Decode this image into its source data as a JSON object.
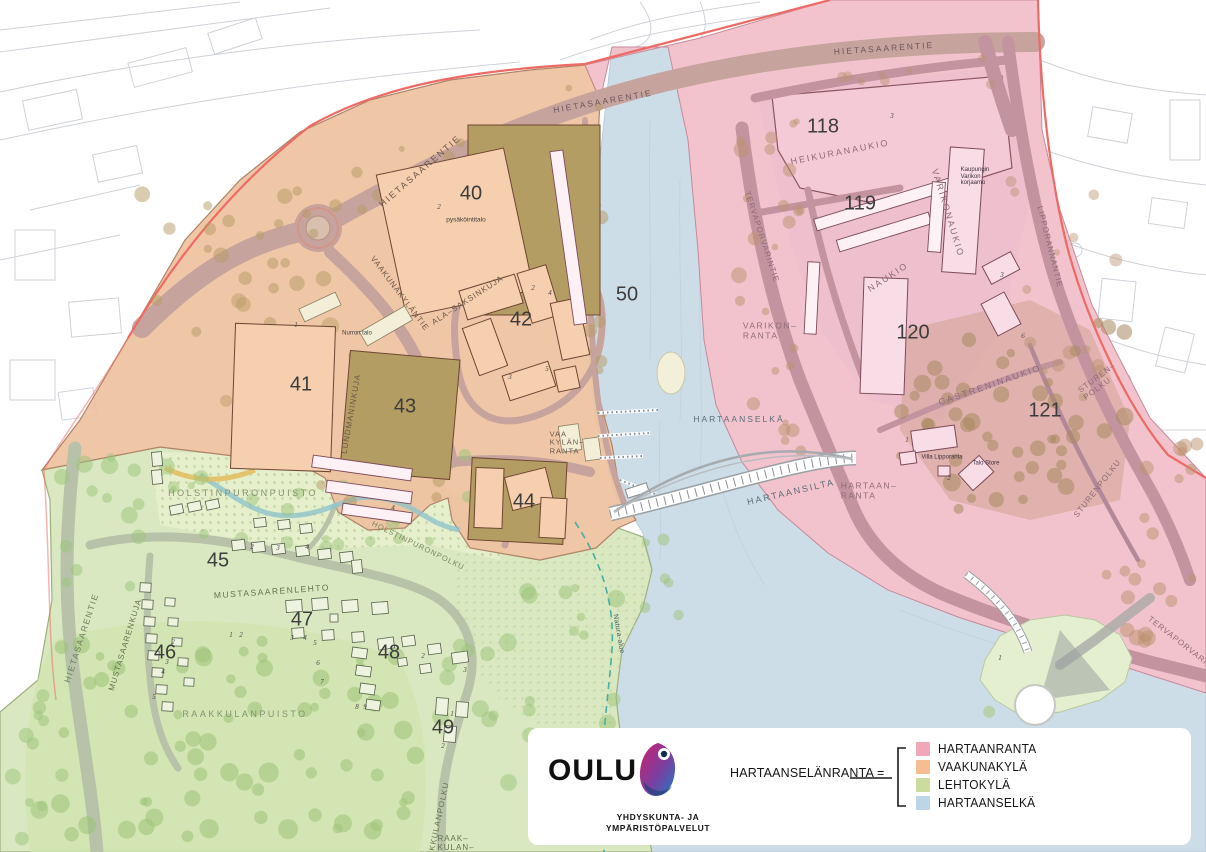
{
  "legend": {
    "logo_text": "OULU",
    "org_line1": "YHDYSKUNTA- JA",
    "org_line2": "YMPÄRISTÖPALVELUT",
    "equation_label": "HARTAANSELÄNRANTA =",
    "items": [
      {
        "label": "HARTAANRANTA",
        "color": "#f2a7b8"
      },
      {
        "label": "VAAKUNAKYLÄ",
        "color": "#f6bd92"
      },
      {
        "label": "LEHTOKYLÄ",
        "color": "#cadd9f"
      },
      {
        "label": "HARTAANSELKÄ",
        "color": "#bcd5e7"
      }
    ]
  },
  "map": {
    "zones": [
      {
        "name": "HARTAANRANTA",
        "color": "#f1bfc9"
      },
      {
        "name": "VAAKUNAKYLÄ",
        "color": "#eec19e"
      },
      {
        "name": "LEHTOKYLÄ",
        "color": "#d9e8c0"
      },
      {
        "name": "HARTAANSELKÄ",
        "color": "#cddde8"
      }
    ],
    "block_numbers": [
      {
        "t": "40",
        "x": 471,
        "y": 194
      },
      {
        "t": "41",
        "x": 301,
        "y": 385
      },
      {
        "t": "42",
        "x": 521,
        "y": 320
      },
      {
        "t": "43",
        "x": 405,
        "y": 407
      },
      {
        "t": "44",
        "x": 524,
        "y": 502
      },
      {
        "t": "45",
        "x": 218,
        "y": 561
      },
      {
        "t": "46",
        "x": 165,
        "y": 653
      },
      {
        "t": "47",
        "x": 302,
        "y": 620
      },
      {
        "t": "48",
        "x": 389,
        "y": 653
      },
      {
        "t": "49",
        "x": 443,
        "y": 728
      },
      {
        "t": "50",
        "x": 627,
        "y": 295
      },
      {
        "t": "118",
        "x": 823,
        "y": 127
      },
      {
        "t": "119",
        "x": 860,
        "y": 204
      },
      {
        "t": "120",
        "x": 913,
        "y": 333
      },
      {
        "t": "121",
        "x": 1045,
        "y": 411
      }
    ],
    "plot_numbers": [
      {
        "t": "2",
        "x": 439,
        "y": 207
      },
      {
        "t": "1",
        "x": 296,
        "y": 325
      },
      {
        "t": "2",
        "x": 533,
        "y": 288
      },
      {
        "t": "4",
        "x": 550,
        "y": 293
      },
      {
        "t": "5",
        "x": 547,
        "y": 369
      },
      {
        "t": "3",
        "x": 510,
        "y": 377
      },
      {
        "t": "3",
        "x": 892,
        "y": 116
      },
      {
        "t": "3",
        "x": 1002,
        "y": 275
      },
      {
        "t": "6",
        "x": 1023,
        "y": 336
      },
      {
        "t": "1",
        "x": 907,
        "y": 440
      },
      {
        "t": "2",
        "x": 949,
        "y": 478
      },
      {
        "t": "2",
        "x": 252,
        "y": 547
      },
      {
        "t": "3",
        "x": 278,
        "y": 548
      },
      {
        "t": "4",
        "x": 307,
        "y": 547
      },
      {
        "t": "2",
        "x": 173,
        "y": 642
      },
      {
        "t": "3",
        "x": 167,
        "y": 662
      },
      {
        "t": "4",
        "x": 163,
        "y": 672
      },
      {
        "t": "5",
        "x": 154,
        "y": 697
      },
      {
        "t": "1",
        "x": 231,
        "y": 635
      },
      {
        "t": "2",
        "x": 241,
        "y": 635
      },
      {
        "t": "3",
        "x": 292,
        "y": 638
      },
      {
        "t": "4",
        "x": 305,
        "y": 638
      },
      {
        "t": "5",
        "x": 315,
        "y": 643
      },
      {
        "t": "6",
        "x": 318,
        "y": 663
      },
      {
        "t": "7",
        "x": 322,
        "y": 682
      },
      {
        "t": "8",
        "x": 357,
        "y": 707
      },
      {
        "t": "9",
        "x": 365,
        "y": 707
      },
      {
        "t": "2",
        "x": 423,
        "y": 656
      },
      {
        "t": "3",
        "x": 465,
        "y": 670
      },
      {
        "t": "1",
        "x": 452,
        "y": 714
      },
      {
        "t": "2",
        "x": 443,
        "y": 746
      },
      {
        "t": "4",
        "x": 393,
        "y": 508
      },
      {
        "t": "1",
        "x": 1000,
        "y": 658
      }
    ],
    "labels": [
      {
        "n": "road-label-hietasaarentie-top",
        "t": "HIETASAARENTIE",
        "x": 603,
        "y": 102,
        "r": -10,
        "s": 8.5,
        "sp": 2,
        "c": "#70555c"
      },
      {
        "n": "road-label-hietasaarentie-topright",
        "t": "HIETASAARENTIE",
        "x": 884,
        "y": 49,
        "r": -4,
        "s": 8.5,
        "sp": 2,
        "c": "#70555c"
      },
      {
        "n": "road-label-hietasaarentie-upperleft",
        "t": "HIETASAARENTIE",
        "x": 420,
        "y": 171,
        "r": -41,
        "s": 9,
        "sp": 2,
        "c": "#6b584b"
      },
      {
        "n": "road-label-hietasaarentie-left",
        "t": "HIETASAARENTIE",
        "x": 82,
        "y": 638,
        "r": -72,
        "s": 8.5,
        "sp": 1.5,
        "c": "#6f7c5e"
      },
      {
        "n": "road-label-vaakunakylantie",
        "t": "VAAKUNAKYLÄNTIE",
        "x": 399,
        "y": 294,
        "r": 53,
        "s": 8,
        "sp": 1,
        "c": "#6b584b"
      },
      {
        "n": "road-label-ala-saksinkuja",
        "t": "ALA–SAKSINKUJA",
        "x": 468,
        "y": 301,
        "r": -33,
        "s": 8,
        "sp": 1,
        "c": "#6b584b"
      },
      {
        "n": "road-label-lundmaninkuja",
        "t": "LUNDMANINKUJA",
        "x": 352,
        "y": 414,
        "r": -80,
        "s": 8,
        "sp": 1,
        "c": "#6b584b"
      },
      {
        "n": "road-label-vaakylanranta",
        "lines": [
          "VAA",
          "KYLÄN–",
          "RANTA"
        ],
        "x": 567,
        "y": 443,
        "r": 0,
        "s": 7.5,
        "sp": 1,
        "c": "#6b584b",
        "a": "left"
      },
      {
        "n": "park-label-holstinpuronpuisto",
        "t": "HOLSTINPURONPUISTO",
        "x": 243,
        "y": 493,
        "r": 0,
        "s": 9,
        "sp": 2.5,
        "c": "#849270"
      },
      {
        "n": "road-label-mustasaarenlehto",
        "t": "MUSTASAARENLEHTO",
        "x": 272,
        "y": 592,
        "r": -4,
        "s": 8.5,
        "sp": 1.5,
        "c": "#66724f"
      },
      {
        "n": "road-label-mustasaarenkuja",
        "t": "MUSTASAARENKUJA",
        "x": 126,
        "y": 645,
        "r": -73,
        "s": 8,
        "sp": 1,
        "c": "#66724f"
      },
      {
        "n": "park-label-raakkulanpuisto",
        "t": "RAAKKULANPUISTO",
        "x": 245,
        "y": 714,
        "r": 0,
        "s": 9,
        "sp": 2.5,
        "c": "#849270"
      },
      {
        "n": "road-label-raakkulanpolku",
        "t": "RAAKKULANPOLKU",
        "x": 438,
        "y": 826,
        "r": -78,
        "s": 8,
        "sp": 1,
        "c": "#66724f"
      },
      {
        "n": "road-label-raakkulan",
        "lines": [
          "RAAK–",
          "KULAN–"
        ],
        "x": 456,
        "y": 844,
        "r": 0,
        "s": 8,
        "sp": 1,
        "c": "#66724f",
        "a": "left"
      },
      {
        "n": "road-label-holstinpuronpolku",
        "t": "HOLSTINPURONPOLKU",
        "x": 418,
        "y": 546,
        "r": 26,
        "s": 7.5,
        "sp": 1,
        "c": "#78865e"
      },
      {
        "n": "square-label-heikuranaukio",
        "t": "HEIKURANAUKIO",
        "x": 840,
        "y": 152,
        "r": -11,
        "s": 9,
        "sp": 2,
        "c": "#8f6b77"
      },
      {
        "n": "square-label-varikonaukio",
        "t": "VARIKONAUKIO",
        "x": 948,
        "y": 213,
        "r": 73,
        "s": 9,
        "sp": 2,
        "c": "#8f6b77"
      },
      {
        "n": "square-label-naukio",
        "t": "NAUKIO",
        "x": 888,
        "y": 277,
        "r": -33,
        "s": 9,
        "sp": 2,
        "c": "#8f6b77"
      },
      {
        "n": "square-label-castreninaukio",
        "t": "CASTRENINAUKIO",
        "x": 990,
        "y": 385,
        "r": -19,
        "s": 9,
        "sp": 2,
        "c": "#8f6b77"
      },
      {
        "n": "road-label-sturen-polku",
        "lines": [
          "STUREN–",
          "POLKU"
        ],
        "x": 1100,
        "y": 382,
        "r": -37,
        "s": 8,
        "sp": 1,
        "c": "#8f6b77",
        "a": "left"
      },
      {
        "n": "road-label-sturenpolku",
        "t": "STURENPOLKU",
        "x": 1098,
        "y": 489,
        "r": -52,
        "s": 8,
        "sp": 1,
        "c": "#8f6b77"
      },
      {
        "n": "road-label-lipporannantie",
        "t": "LIPPORANNANTIE",
        "x": 1049,
        "y": 247,
        "r": 76,
        "s": 8,
        "sp": 1,
        "c": "#8f6b77"
      },
      {
        "n": "road-label-tervaporvarintie",
        "t": "TERVAPORVARINTIE",
        "x": 761,
        "y": 237,
        "r": 72,
        "s": 8,
        "sp": 1,
        "c": "#8f6b77"
      },
      {
        "n": "road-label-tervaporvarintie-south",
        "t": "TERVAPORVARINTIE",
        "x": 1186,
        "y": 648,
        "r": 38,
        "s": 8,
        "sp": 1,
        "c": "#8f6b77"
      },
      {
        "n": "shore-label-varikonranta",
        "lines": [
          "VARIKON–",
          "RANTA"
        ],
        "x": 770,
        "y": 331,
        "r": 0,
        "s": 8.5,
        "sp": 1.5,
        "c": "#8f6b77",
        "a": "left"
      },
      {
        "n": "water-label-hartaanselka",
        "t": "HARTAANSELKÄ",
        "x": 739,
        "y": 420,
        "r": 0,
        "s": 8.5,
        "sp": 2,
        "c": "#5d6e7a"
      },
      {
        "n": "bridge-label-hartaansilta",
        "t": "HARTAANSILTA",
        "x": 791,
        "y": 492,
        "r": -13,
        "s": 9,
        "sp": 2,
        "c": "#5d6e7a"
      },
      {
        "n": "shore-label-hartaanranta",
        "lines": [
          "HARTAAN–",
          "RANTA"
        ],
        "x": 869,
        "y": 491,
        "r": 0,
        "s": 8.5,
        "sp": 1.5,
        "c": "#8f6b77",
        "a": "left"
      },
      {
        "n": "label-natura-alue",
        "t": "Natura-alue",
        "x": 618,
        "y": 634,
        "r": 80,
        "s": 7,
        "sp": 0.3,
        "c": "#47606b"
      },
      {
        "n": "building-label-pysakointitalo",
        "t": "pysäköintitalo",
        "x": 466,
        "y": 220,
        "r": 0,
        "s": 6.5,
        "sp": 0,
        "c": "#3d3d3d"
      },
      {
        "n": "building-label-nurron-talo",
        "t": "Nurron talo",
        "x": 357,
        "y": 334,
        "r": 0,
        "s": 6,
        "sp": 0,
        "c": "#3d3d3d"
      },
      {
        "n": "building-label-varikon-korjaamo",
        "lines": [
          "Kaupungin",
          "Varikon",
          "korjaamo"
        ],
        "x": 975,
        "y": 177,
        "r": 0,
        "s": 6,
        "sp": 0,
        "c": "#3d3040",
        "a": "left"
      },
      {
        "n": "building-label-villa-lipporanta",
        "t": "Villa Lipporanta",
        "x": 942,
        "y": 458,
        "r": 0,
        "s": 6,
        "sp": 0,
        "c": "#3d3040"
      },
      {
        "n": "building-label-talo-store",
        "t": "Talo Store",
        "x": 986,
        "y": 464,
        "r": 0,
        "s": 6,
        "sp": 0,
        "c": "#3d3040"
      }
    ]
  }
}
